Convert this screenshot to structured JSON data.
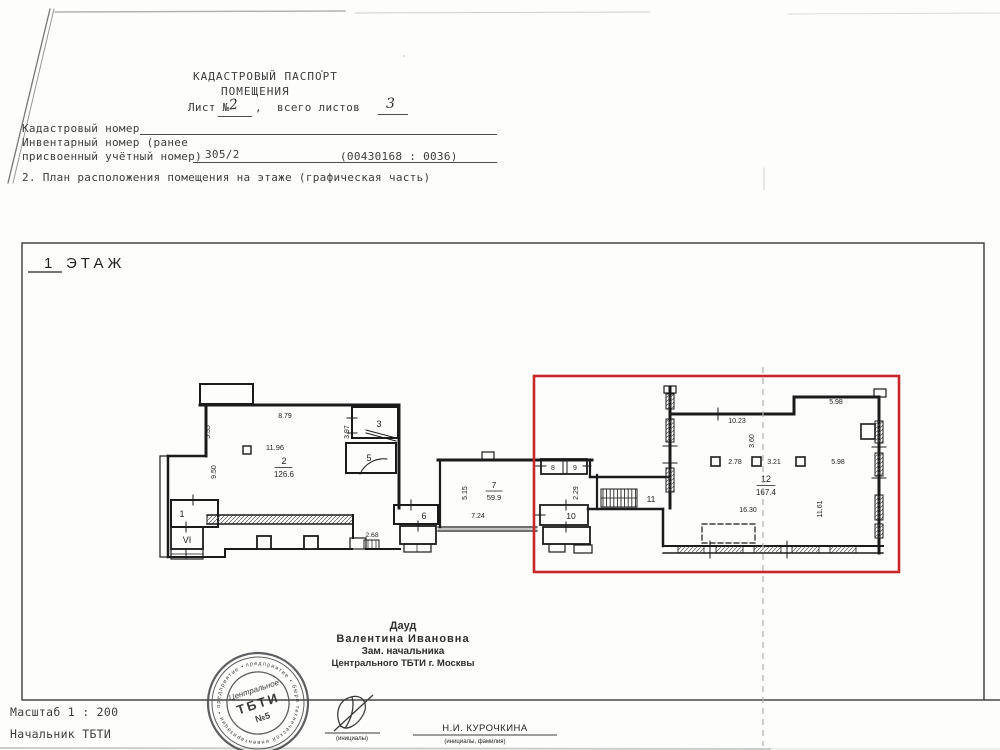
{
  "header": {
    "title_line1": "КАДАСТРОВЫЙ ПАСПОРТ",
    "title_line2": "ПОМЕЩЕНИЯ",
    "sheet_label": "Лист №",
    "sheet_number": "2",
    "sheet_comma": ",",
    "total_label": "всего листов",
    "total_number": "3",
    "cadastral_number_label": "Кадастровый номер",
    "inventory_label_line1": "Инвентарный номер (ранее",
    "inventory_label_line2": "присвоенный учётный номер)",
    "inventory_number": "305/2",
    "registry_code": "(00430168 : 0036)",
    "section_heading": "2. План расположения помещения на этаже (графическая часть)"
  },
  "plan": {
    "floor_number": "1",
    "floor_label": "ЭТАЖ",
    "rooms": {
      "r1": "1",
      "rVI": "VI",
      "r2": "2",
      "r2_area": "126.6",
      "r3": "3",
      "r5": "5",
      "r6": "6",
      "r7": "7",
      "r7_area": "59.9",
      "r8": "8",
      "r9": "9",
      "r10": "10",
      "r11": "11",
      "r12": "12",
      "r12_area": "167.4"
    },
    "dims": {
      "d879": "8.79",
      "d535": "5.35",
      "d950": "9.50",
      "d1196": "11.96",
      "d397": "3.97",
      "d268": "2.68",
      "d724": "7.24",
      "d515": "5.15",
      "d229": "2.29",
      "d1023": "10.23",
      "d598top": "5.98",
      "d360": "3.60",
      "d278": "2.78",
      "d321": "3.21",
      "d598mid": "5.98",
      "d1630": "16.30",
      "d1161": "11.61"
    }
  },
  "footer": {
    "scale": "Масштаб 1 : 200",
    "chief_title": "Начальник ТБТИ",
    "official": {
      "line1": "Дауд",
      "line2": "Валентина Ивановна",
      "line3": "Зам. начальника",
      "line4": "Центрального ТБТИ г. Москвы"
    },
    "signature_caption": "(инициалы)",
    "signed_name": "Н.И. КУРОЧКИНА",
    "signed_name_caption": "(инициалы, фамилия)",
    "stamp": {
      "center_line1": "Центральное",
      "center_line2": "ТБТИ",
      "center_line3": "№5",
      "ring_text": "предприятие • бюро технической инвентаризации • предприятие • бюро технической •"
    }
  },
  "colors": {
    "highlight_red": "#c62828",
    "ink": "#1b1b1b",
    "stamp": "#4a4a4c"
  }
}
